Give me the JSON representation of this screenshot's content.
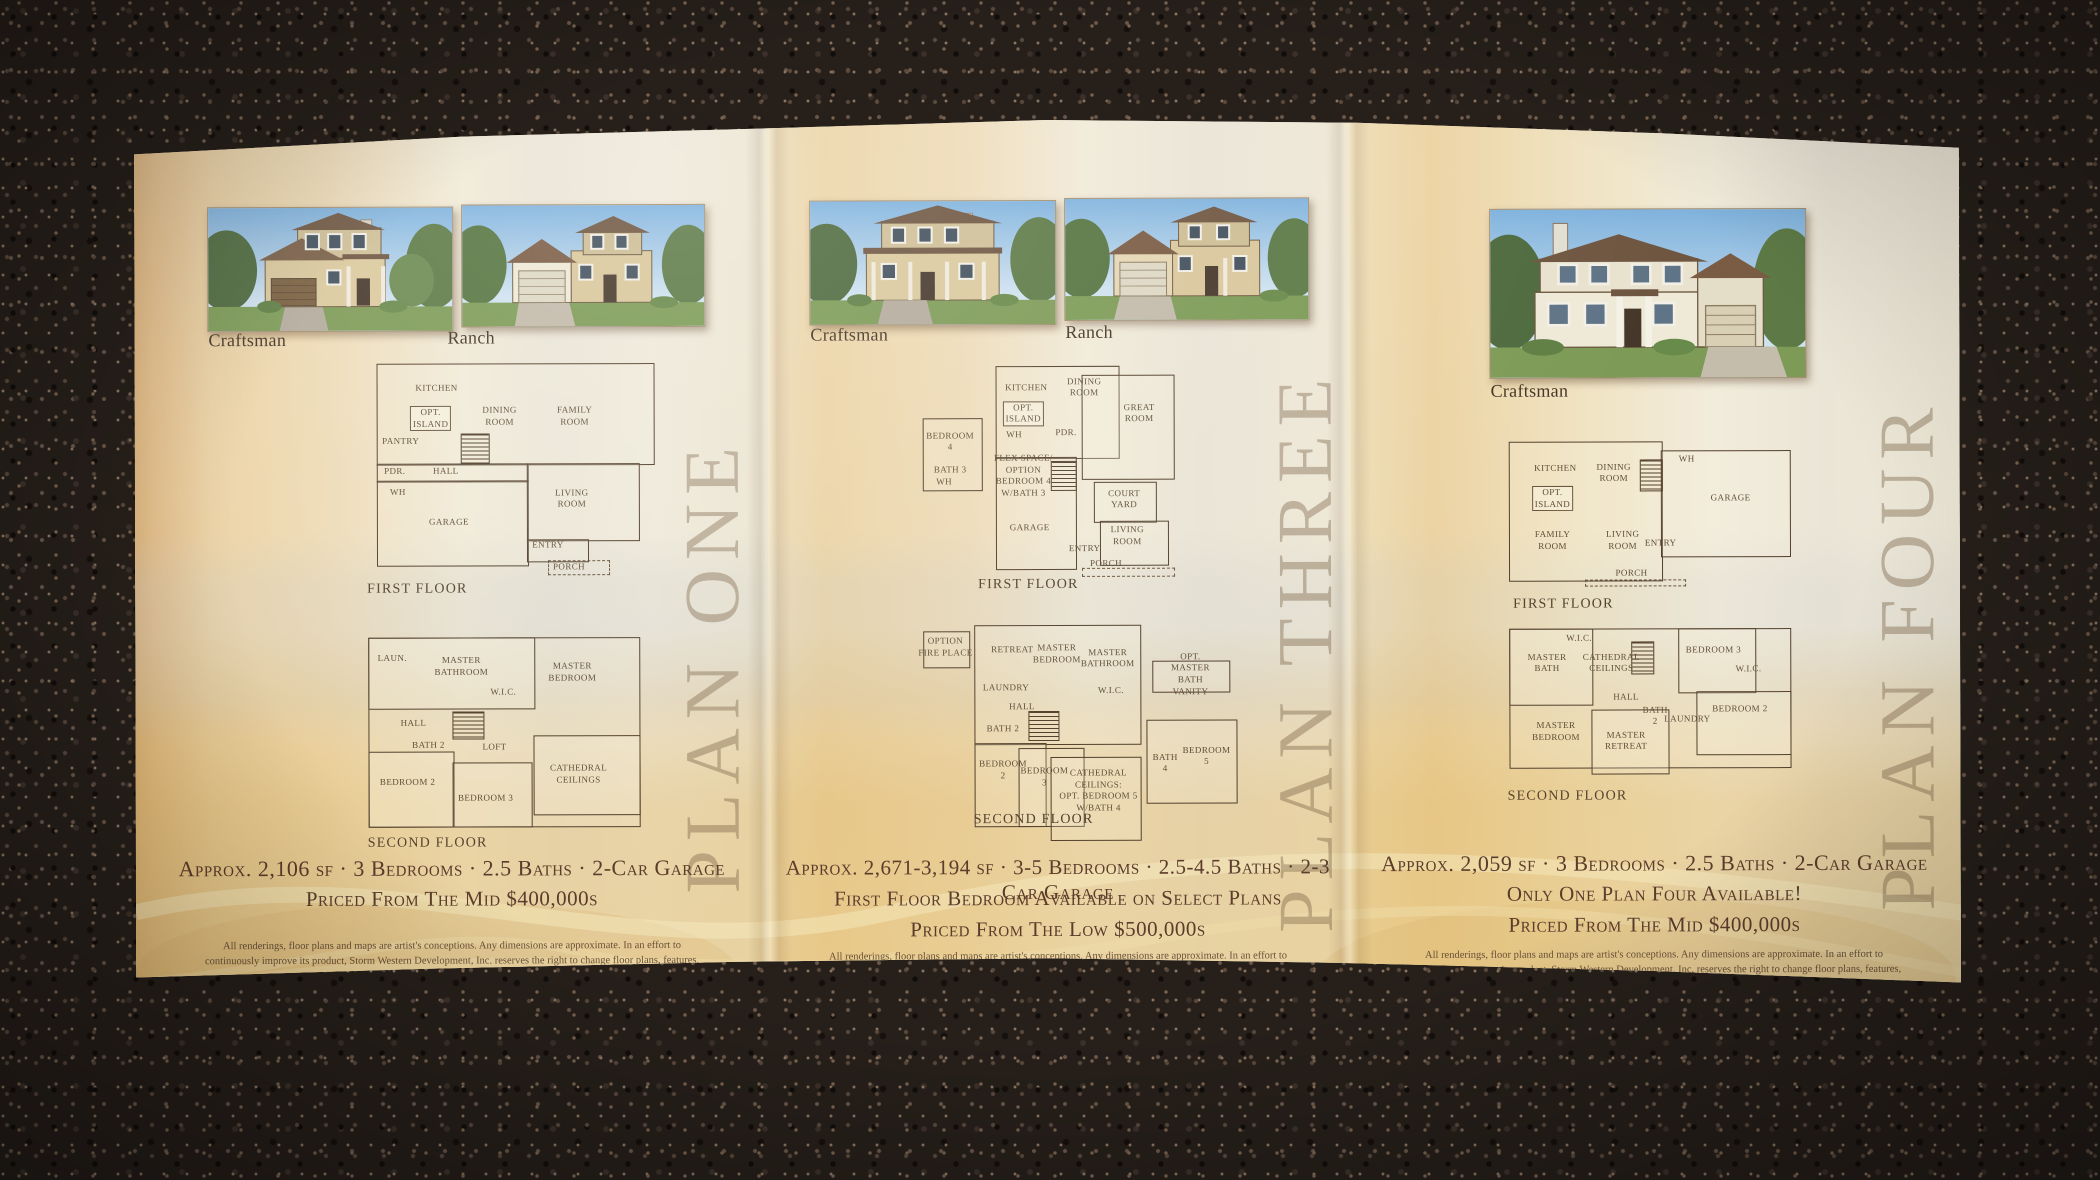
{
  "scene": {
    "surface": "dark granite countertop",
    "object": "trifold real-estate brochure"
  },
  "colors": {
    "granite": "#261f1a",
    "paper_tan": "#ecd2a4",
    "paper_cream": "#f0e9d6",
    "gold_band": "#e0ba84",
    "ink": "#5c3c2b",
    "plan_line": "#53402c",
    "watermark": "#7c634f"
  },
  "brochure": {
    "disclaimer": "All renderings, floor plans and maps are artist's conceptions. Any dimensions are approximate. In an effort to continuously improve its product, Storm Western Development, Inc. reserves the right to change floor plans, features, specifications and prices without notice.",
    "panels": [
      {
        "name": "PLAN ONE",
        "images": [
          {
            "label": "Craftsman"
          },
          {
            "label": "Ranch"
          }
        ],
        "first_floor": {
          "caption": "FIRST FLOOR",
          "rooms": [
            "KITCHEN",
            "OPT.\nISLAND",
            "DINING\nROOM",
            "FAMILY\nROOM",
            "PANTRY",
            "PDR.",
            "HALL",
            "WH",
            "GARAGE",
            "LIVING\nROOM",
            "ENTRY",
            "PORCH"
          ]
        },
        "second_floor": {
          "caption": "SECOND FLOOR",
          "rooms": [
            "LAUN.",
            "MASTER\nBATHROOM",
            "MASTER\nBEDROOM",
            "W.I.C.",
            "HALL",
            "BATH 2",
            "LOFT",
            "BEDROOM 2",
            "BEDROOM 3",
            "CATHEDRAL\nCEILINGS"
          ]
        },
        "specs": "Approx. 2,106 sf · 3 Bedrooms · 2.5 Baths · 2-Car Garage",
        "price": "Priced From The Mid $400,000s"
      },
      {
        "name": "PLAN THREE",
        "images": [
          {
            "label": "Craftsman"
          },
          {
            "label": "Ranch"
          }
        ],
        "first_floor": {
          "caption": "FIRST FLOOR",
          "rooms": [
            "KITCHEN",
            "OPT.\nISLAND",
            "DINING\nROOM",
            "GREAT\nROOM",
            "WH",
            "PDR.",
            "FLEX SPACE/\nOPTION\nBEDROOM 4\nW/BATH 3",
            "GARAGE",
            "COURT\nYARD",
            "LIVING\nROOM",
            "ENTRY",
            "PORCH"
          ],
          "inset": [
            "BEDROOM\n4",
            "BATH 3",
            "WH"
          ]
        },
        "second_floor": {
          "caption": "SECOND FLOOR",
          "rooms": [
            "OPTION\nFIRE PLACE",
            "RETREAT",
            "MASTER\nBEDROOM",
            "MASTER\nBATHROOM",
            "LAUNDRY",
            "HALL",
            "W.I.C.",
            "BATH 2",
            "BEDROOM\n2",
            "BEDROOM\n3",
            "CATHEDRAL\nCEILINGS:\nOPT. BEDROOM 5\nW/BATH 4"
          ],
          "insets": [
            "OPT.\nMASTER\nBATH VANITY",
            "BATH\n4",
            "BEDROOM\n5"
          ]
        },
        "specs": "Approx. 2,671-3,194 sf · 3-5 Bedrooms · 2.5-4.5 Baths · 2-3 Car Garage",
        "note": "First Floor Bedroom Available on Select Plans",
        "price": "Priced From The Low $500,000s"
      },
      {
        "name": "PLAN FOUR",
        "images": [
          {
            "label": "Craftsman"
          }
        ],
        "first_floor": {
          "caption": "FIRST FLOOR",
          "rooms": [
            "KITCHEN",
            "OPT.\nISLAND",
            "DINING\nROOM",
            "WH",
            "GARAGE",
            "FAMILY\nROOM",
            "LIVING\nROOM",
            "ENTRY",
            "PORCH"
          ]
        },
        "second_floor": {
          "caption": "SECOND FLOOR",
          "rooms": [
            "MASTER\nBATH",
            "W.I.C.",
            "CATHEDRAL\nCEILINGS",
            "BEDROOM 3",
            "W.I.C.",
            "HALL",
            "BEDROOM 2",
            "BATH\n2",
            "LAUNDRY",
            "MASTER\nBEDROOM",
            "MASTER\nRETREAT"
          ]
        },
        "specs": "Approx. 2,059 sf · 3 Bedrooms · 2.5 Baths · 2-Car Garage",
        "note": "Only One Plan Four Available!",
        "price": "Priced From The Mid $400,000s"
      }
    ]
  }
}
